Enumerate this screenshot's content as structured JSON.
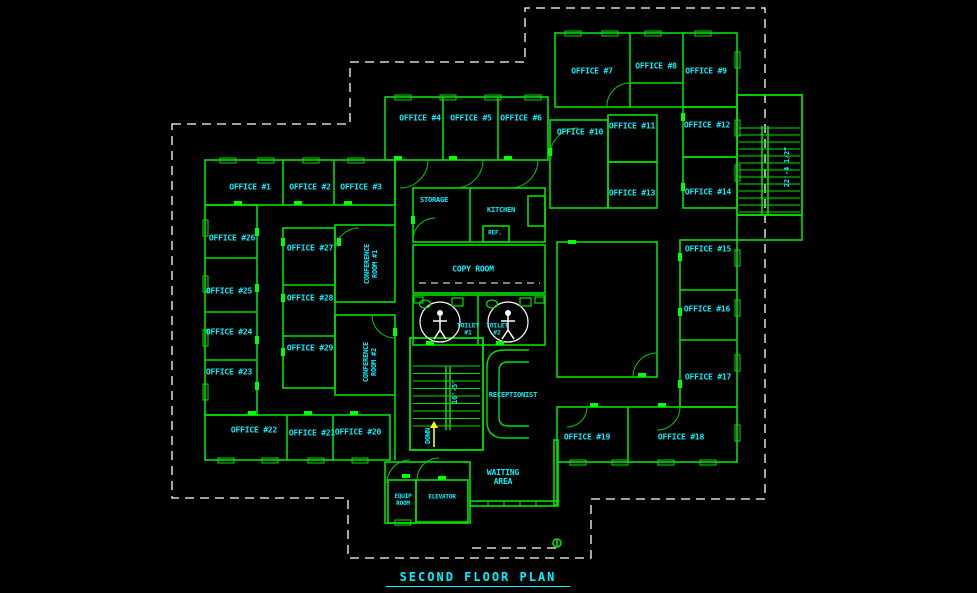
{
  "title": {
    "text": "SECOND FLOOR PLAN"
  },
  "colors": {
    "background": "#000000",
    "walls": "#00e000",
    "door_jamb": "#00ff00",
    "text": "#00f2ff",
    "boundary_dash": "#ffffff",
    "down_arrow": "#ffff00",
    "toilet_symbol": "#ffffff"
  },
  "rooms": {
    "office_1": "OFFICE #1",
    "office_2": "OFFICE #2",
    "office_3": "OFFICE #3",
    "office_4": "OFFICE #4",
    "office_5": "OFFICE #5",
    "office_6": "OFFICE #6",
    "office_7": "OFFICE #7",
    "office_8": "OFFICE #8",
    "office_9": "OFFICE #9",
    "office_10": "OFFICE #10",
    "office_11": "OFFICE #11",
    "office_12": "OFFICE #12",
    "office_13": "OFFICE #13",
    "office_14": "OFFICE #14",
    "office_15": "OFFICE #15",
    "office_16": "OFFICE #16",
    "office_17": "OFFICE #17",
    "office_18": "OFFICE #18",
    "office_19": "OFFICE #19",
    "office_20": "OFFICE #20",
    "office_21": "OFFICE #21",
    "office_22": "OFFICE #22",
    "office_23": "OFFICE #23",
    "office_24": "OFFICE #24",
    "office_25": "OFFICE #25",
    "office_26": "OFFICE #26",
    "office_27": "OFFICE #27",
    "office_28": "OFFICE #28",
    "office_29": "OFFICE #29",
    "conference_1": "CONFERENCE\nROOM #1",
    "conference_2": "CONFERENCE\nROOM #2",
    "storage": "STORAGE",
    "kitchen": "KITCHEN",
    "refrigerator": "REF.",
    "copy_room": "COPY ROOM",
    "toilet_1": "TOILET\n#1",
    "toilet_2": "TOILET\n#2",
    "receptionist": "RECEPTIONIST",
    "waiting_area": "WAITING\nAREA",
    "elevator": "ELEVATOR",
    "equip_room": "EQUIP\nROOM"
  },
  "annotations": {
    "stair_down": "DOWN",
    "stair_interior_dim": "16'-5\"",
    "stair_exterior_dim": "22'-4 1/2\""
  }
}
